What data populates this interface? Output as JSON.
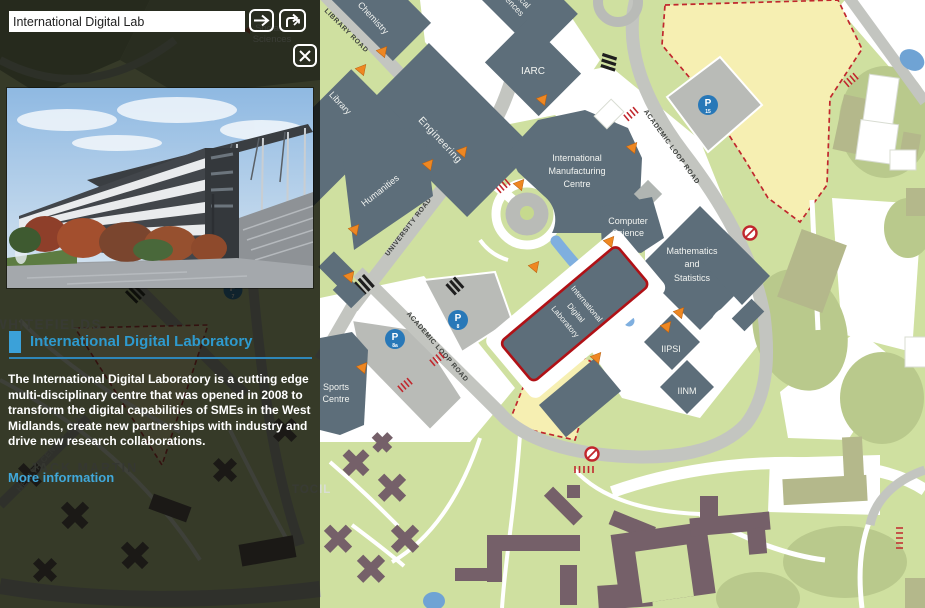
{
  "search": {
    "value": "International Digital Lab"
  },
  "toolbar": {
    "go_icon": "right-arrow",
    "directions_icon": "route-fork-arrow",
    "close_icon": "x-mark"
  },
  "panel": {
    "title": "International Digital Laboratory",
    "description": "The International Digital Laboratory is a cutting edge multi-disciplinary centre that was opened in 2008 to transform the digital capabilities of SMEs in the West Midlands, create new partnerships with industry and drive new research collaborations.",
    "more_link": "More information"
  },
  "background": {
    "whitefields": "WHITEFIELDS",
    "jack_martin": "JACK MARTIN",
    "tocil": "TOCIL",
    "health_centre_road": "HEALTH CENTRE ROAD",
    "social_sciences_line1": "Social",
    "social_sciences_line2": "Sciences"
  },
  "map": {
    "roads": {
      "library_road": "LIBRARY ROAD",
      "university_road": "UNIVERSITY ROAD",
      "academic_loop_upper": "ACADEMIC LOOP ROAD",
      "academic_loop_lower": "ACADEMIC LOOP ROAD"
    },
    "buildings": {
      "chemistry": "Chemistry",
      "physical_sciences_line1": "Physical",
      "physical_sciences_line2": "Sciences",
      "engineering": "Engineering",
      "library": "Library",
      "humanities": "Humanities",
      "iarc": "IARC",
      "imc_line1": "International",
      "imc_line2": "Manufacturing",
      "imc_line3": "Centre",
      "computer_science_line1": "Computer",
      "computer_science_line2": "Science",
      "maths_line1": "Mathematics",
      "maths_line2": "and",
      "maths_line3": "Statistics",
      "iipsi": "IIPSI",
      "iinm": "IINM",
      "idl_line1": "International",
      "idl_line2": "Digital",
      "idl_line3": "Laboratory",
      "sports_line1": "Sports",
      "sports_line2": "Centre"
    },
    "parking": {
      "p15_letter": "P",
      "p15_num": "15",
      "p8_letter": "P",
      "p8_num": "8",
      "p8a_letter": "P",
      "p8a_num": "8a",
      "p7_letter": "P",
      "p7_num": "7"
    },
    "colors": {
      "accent_blue": "#2e9ace",
      "link_blue": "#41a8da",
      "highlight_red": "#b01116",
      "marker_orange": "#ee8722",
      "parking_blue": "#2878b8",
      "zone_yellow": "#f6efb2",
      "zone_border_red": "#c1272d",
      "building_slate": "#5d6e7a",
      "residence_brown": "#756069",
      "ground_green": "#cfe0a0"
    }
  }
}
